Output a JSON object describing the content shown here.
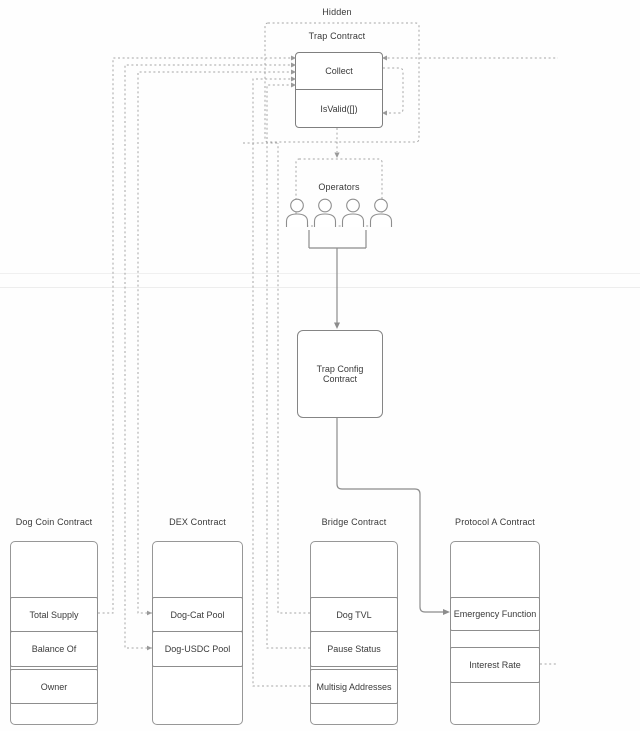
{
  "hidden_group": {
    "label": "Hidden"
  },
  "trap_contract": {
    "label": "Trap Contract",
    "functions": [
      "Collect",
      "IsValid([])"
    ]
  },
  "operators": {
    "label": "Operators",
    "count": 4
  },
  "trap_config": {
    "label": "Trap Config Contract"
  },
  "contracts": [
    {
      "title": "Dog Coin Contract",
      "functions": [
        "Total Supply",
        "Balance Of",
        "Owner"
      ]
    },
    {
      "title": "DEX Contract",
      "functions": [
        "Dog-Cat Pool",
        "Dog-USDC Pool"
      ]
    },
    {
      "title": "Bridge Contract",
      "functions": [
        "Dog TVL",
        "Pause Status",
        "Multisig Addresses"
      ]
    },
    {
      "title": "Protocol A Contract",
      "functions": [
        "Emergency Function",
        "Interest Rate"
      ]
    }
  ],
  "colors": {
    "dashed_line": "#a5a5a5",
    "solid_line": "#8c8c8c",
    "box_border": "#8f8f8f",
    "text": "#3a3a3a",
    "background": "#fefefe"
  }
}
